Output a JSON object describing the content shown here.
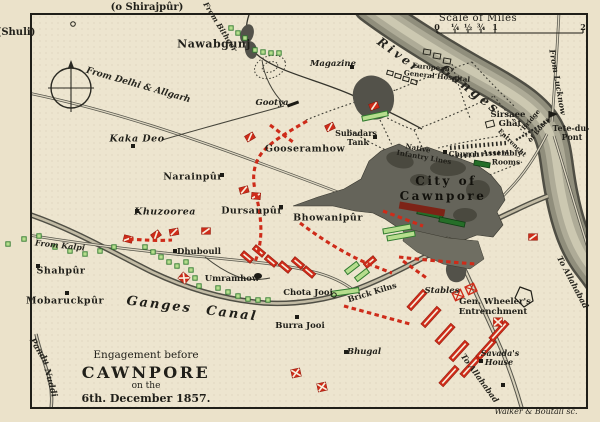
{
  "map": {
    "title_block": {
      "line1": "Engagement before",
      "line2": "CAWNPORE",
      "line3": "on the",
      "line4": "6th. December 1857."
    },
    "scale": {
      "title": "Scale of Miles",
      "ticks": [
        {
          "label": "0",
          "x": 437
        },
        {
          "label": "¼",
          "x": 455
        },
        {
          "label": "½",
          "x": 468
        },
        {
          "label": "¾",
          "x": 481
        },
        {
          "label": "1",
          "x": 495
        },
        {
          "label": "2",
          "x": 583
        }
      ]
    },
    "colors": {
      "paper": "#ebe2ca",
      "map_paper": "#ede5cf",
      "ink": "#201f19",
      "red": "#ce2b19",
      "green_fill": "#b6dd8d",
      "green_dark": "#2f7b2e",
      "river_body": "#908e7c",
      "city_fill": "#65645a"
    },
    "labels": [
      {
        "t": "(o Shirajpûr)",
        "x": 147,
        "y": 8,
        "r": 0,
        "c": "out",
        "s": 10
      },
      {
        "t": "(Shuli)",
        "x": 16,
        "y": 33,
        "r": 0,
        "c": "out",
        "s": 10
      },
      {
        "t": "Walker & Boutall sc.",
        "x": 536,
        "y": 412,
        "r": 0,
        "c": "eng",
        "s": 8
      },
      {
        "t": "Nawabgunj",
        "x": 214,
        "y": 44,
        "r": 0,
        "c": "big",
        "s": 11
      },
      {
        "t": "Magazine",
        "x": 333,
        "y": 64,
        "r": 0,
        "c": "pi",
        "s": 8.5
      },
      {
        "t": "Gootya",
        "x": 272,
        "y": 103,
        "r": 0,
        "c": "pi",
        "s": 8.5
      },
      {
        "t": "European",
        "x": 431,
        "y": 67,
        "r": 6,
        "c": "t",
        "s": 7
      },
      {
        "t": "General Hospital",
        "x": 437,
        "y": 76,
        "r": 6,
        "c": "t",
        "s": 7
      },
      {
        "t": "Sirsaee",
        "x": 508,
        "y": 115,
        "r": 0,
        "c": "p",
        "s": 8.5
      },
      {
        "t": "Ghât",
        "x": 510,
        "y": 124,
        "r": 0,
        "c": "p",
        "s": 8.5
      },
      {
        "t": "Tete-du-",
        "x": 571,
        "y": 128,
        "r": 0,
        "c": "p",
        "s": 8
      },
      {
        "t": "Pont",
        "x": 572,
        "y": 137,
        "r": 0,
        "c": "p",
        "s": 8
      },
      {
        "t": "Bridge",
        "x": 531,
        "y": 120,
        "r": -50,
        "c": "t",
        "s": 6.5
      },
      {
        "t": "of Boats",
        "x": 539,
        "y": 130,
        "r": -50,
        "c": "t",
        "s": 6.5
      },
      {
        "t": "Entrencht",
        "x": 512,
        "y": 143,
        "r": 44,
        "c": "t",
        "s": 6.5
      },
      {
        "t": "Church",
        "x": 464,
        "y": 154,
        "r": 0,
        "c": "p",
        "s": 7.5
      },
      {
        "t": "Assembly",
        "x": 502,
        "y": 153,
        "r": 0,
        "c": "p",
        "s": 7.5
      },
      {
        "t": "Rooms",
        "x": 506,
        "y": 162,
        "r": 0,
        "c": "p",
        "s": 7.5
      },
      {
        "t": "Native",
        "x": 418,
        "y": 148,
        "r": 10,
        "c": "p",
        "s": 7
      },
      {
        "t": "Infantry Lines",
        "x": 424,
        "y": 157,
        "r": 10,
        "c": "p",
        "s": 7
      },
      {
        "t": "Subadars",
        "x": 356,
        "y": 133,
        "r": 0,
        "c": "p",
        "s": 8
      },
      {
        "t": "Tank",
        "x": 358,
        "y": 142,
        "r": 0,
        "c": "p",
        "s": 8
      },
      {
        "t": "Gooseramhow",
        "x": 305,
        "y": 149,
        "r": 0,
        "c": "big",
        "s": 9.5
      },
      {
        "t": "Kaka Deo",
        "x": 137,
        "y": 139,
        "r": 0,
        "c": "bigi",
        "s": 9.5
      },
      {
        "t": "Narainpûr",
        "x": 193,
        "y": 177,
        "r": 0,
        "c": "big",
        "s": 9.5
      },
      {
        "t": "Khuzoorea",
        "x": 165,
        "y": 212,
        "r": 0,
        "c": "bigi",
        "s": 9.5
      },
      {
        "t": "Dursanpûr",
        "x": 252,
        "y": 211,
        "r": 0,
        "c": "big",
        "s": 9.5
      },
      {
        "t": "Bhowanipûr",
        "x": 328,
        "y": 218,
        "r": 0,
        "c": "big",
        "s": 9.5
      },
      {
        "t": "City of",
        "x": 446,
        "y": 181,
        "r": 0,
        "c": "city",
        "s": 12
      },
      {
        "t": "Cawnpore",
        "x": 443,
        "y": 196,
        "r": 0,
        "c": "city",
        "s": 12
      },
      {
        "t": "Shahpûr",
        "x": 61,
        "y": 271,
        "r": 0,
        "c": "big",
        "s": 9.5
      },
      {
        "t": "Mobaruckpûr",
        "x": 65,
        "y": 301,
        "r": 0,
        "c": "big",
        "s": 9.5
      },
      {
        "t": "Dhuboull",
        "x": 199,
        "y": 252,
        "r": 0,
        "c": "p",
        "s": 8.5
      },
      {
        "t": "Umramhow",
        "x": 232,
        "y": 279,
        "r": 0,
        "c": "p",
        "s": 8.5
      },
      {
        "t": "Chota Jooi",
        "x": 308,
        "y": 293,
        "r": 0,
        "c": "p",
        "s": 8.5
      },
      {
        "t": "Burra Jooi",
        "x": 300,
        "y": 326,
        "r": 0,
        "c": "p",
        "s": 8.5
      },
      {
        "t": "Brick Kilns",
        "x": 372,
        "y": 292,
        "r": -17,
        "c": "p",
        "s": 8
      },
      {
        "t": "Stables",
        "x": 442,
        "y": 291,
        "r": 0,
        "c": "pi",
        "s": 8.5
      },
      {
        "t": "Gen. Wheeler's",
        "x": 495,
        "y": 302,
        "r": 0,
        "c": "p",
        "s": 8.5
      },
      {
        "t": "Entrenchment",
        "x": 493,
        "y": 312,
        "r": 0,
        "c": "p",
        "s": 8.5
      },
      {
        "t": "Savada's",
        "x": 500,
        "y": 353,
        "r": 0,
        "c": "pi",
        "s": 8
      },
      {
        "t": "House",
        "x": 499,
        "y": 362,
        "r": 0,
        "c": "pi",
        "s": 8
      },
      {
        "t": "Bhugal",
        "x": 364,
        "y": 352,
        "r": 0,
        "c": "pi",
        "s": 8.5
      },
      {
        "t": "River",
        "x": 399,
        "y": 55,
        "r": 36,
        "c": "rv",
        "s": 12
      },
      {
        "t": "Ganges",
        "x": 470,
        "y": 90,
        "r": 38,
        "c": "rv",
        "s": 13
      },
      {
        "t": "From Bithoor",
        "x": 220,
        "y": 27,
        "r": 58,
        "c": "rd",
        "s": 7.5
      },
      {
        "t": "From Delhi & Allgarh",
        "x": 138,
        "y": 86,
        "r": 16,
        "c": "rd",
        "s": 9
      },
      {
        "t": "From Kalpi",
        "x": 60,
        "y": 245,
        "r": 6,
        "c": "rd",
        "s": 8
      },
      {
        "t": "Ganges Canal",
        "x": 192,
        "y": 309,
        "r": 7,
        "c": "canal",
        "s": 13
      },
      {
        "t": "To Allahabad",
        "x": 480,
        "y": 378,
        "r": 54,
        "c": "rd",
        "s": 8
      },
      {
        "t": "To Allahabad",
        "x": 573,
        "y": 282,
        "r": 62,
        "c": "rd",
        "s": 8
      },
      {
        "t": "From Lucknow",
        "x": 558,
        "y": 82,
        "r": 80,
        "c": "rd",
        "s": 8
      },
      {
        "t": "Pandu",
        "x": 39,
        "y": 352,
        "r": 58,
        "c": "rd",
        "s": 8.5
      },
      {
        "t": "Nuddi",
        "x": 50,
        "y": 383,
        "r": 75,
        "c": "rd",
        "s": 8.5
      }
    ],
    "markers": {
      "green_squares": [
        [
          231,
          28
        ],
        [
          238,
          33
        ],
        [
          245,
          38
        ],
        [
          255,
          50
        ],
        [
          263,
          52
        ],
        [
          271,
          53
        ],
        [
          279,
          53
        ],
        [
          8,
          244
        ],
        [
          24,
          239
        ],
        [
          39,
          236
        ],
        [
          55,
          247
        ],
        [
          70,
          251
        ],
        [
          85,
          254
        ],
        [
          100,
          251
        ],
        [
          114,
          247
        ],
        [
          145,
          247
        ],
        [
          153,
          252
        ],
        [
          161,
          257
        ],
        [
          169,
          262
        ],
        [
          177,
          266
        ],
        [
          186,
          262
        ],
        [
          191,
          270
        ],
        [
          195,
          278
        ],
        [
          199,
          286
        ],
        [
          218,
          288
        ],
        [
          228,
          292
        ],
        [
          238,
          296
        ],
        [
          248,
          299
        ],
        [
          258,
          300
        ],
        [
          268,
          300
        ]
      ],
      "green_bars": [
        [
          345,
          292,
          -8,
          28
        ],
        [
          352,
          268,
          -38,
          15
        ],
        [
          362,
          275,
          -38,
          15
        ],
        [
          375,
          116,
          -12,
          26
        ],
        [
          397,
          229,
          -10,
          28
        ],
        [
          401,
          236,
          -10,
          28
        ]
      ],
      "green_bars_dark": [
        [
          430,
          214,
          12,
          26
        ],
        [
          452,
          222,
          12,
          26
        ],
        [
          482,
          164,
          10,
          16
        ]
      ],
      "red_flags": [
        [
          250,
          137,
          -30
        ],
        [
          244,
          190,
          -15
        ],
        [
          256,
          196,
          5
        ],
        [
          174,
          232,
          -10
        ],
        [
          156,
          235,
          -35
        ],
        [
          128,
          239,
          15
        ],
        [
          206,
          231,
          0
        ],
        [
          330,
          127,
          -25
        ],
        [
          374,
          106,
          -20
        ],
        [
          533,
          237,
          0
        ]
      ],
      "red_x": [
        [
          296,
          373,
          -12,
          1
        ],
        [
          322,
          387,
          -12,
          1
        ],
        [
          498,
          322,
          0,
          1
        ],
        [
          184,
          278,
          40,
          1
        ],
        [
          458,
          295,
          -25,
          0
        ],
        [
          471,
          289,
          -25,
          0
        ]
      ],
      "red_bars": [
        [
          417,
          300,
          -48,
          24
        ],
        [
          431,
          317,
          -48,
          24
        ],
        [
          445,
          334,
          -48,
          24
        ],
        [
          459,
          351,
          -48,
          24
        ],
        [
          449,
          376,
          -48,
          24
        ],
        [
          470,
          367,
          -48,
          24
        ],
        [
          486,
          349,
          -48,
          24
        ],
        [
          499,
          331,
          -48,
          24
        ],
        [
          247,
          257,
          40,
          13
        ],
        [
          259,
          251,
          40,
          13
        ],
        [
          271,
          261,
          40,
          13
        ],
        [
          285,
          267,
          40,
          13
        ],
        [
          298,
          263,
          40,
          13
        ],
        [
          309,
          272,
          40,
          13
        ],
        [
          370,
          262,
          -40,
          13
        ]
      ],
      "maroon_bar": [
        422,
        209,
        10,
        46
      ],
      "red_dash_paths": [
        "M307,121 C288,132 270,142 261,154 C254,164 252,176 255,190",
        "M256,194 C260,212 263,230 259,248 C258,254 256,260 254,264",
        "M383,211 C396,216 410,221 423,226",
        "M399,257 C424,260 450,262 476,264",
        "M344,306 C366,312 388,318 410,324",
        "M129,239 C144,240 158,241 172,240",
        "M270,125 C278,131 286,137 293,142",
        "M300,223 C320,238 342,252 364,262 C374,266 384,270 392,273",
        "M403,261 L428,279"
      ],
      "black_squares": [
        [
          352,
          67
        ],
        [
          445,
          152
        ],
        [
          375,
          137
        ],
        [
          222,
          175
        ],
        [
          137,
          211
        ],
        [
          38,
          266
        ],
        [
          67,
          293
        ],
        [
          175,
          251
        ],
        [
          281,
          207
        ],
        [
          297,
          317
        ],
        [
          346,
          352
        ],
        [
          481,
          361
        ],
        [
          503,
          385
        ],
        [
          133,
          146
        ]
      ],
      "black_blob": [
        258,
        276
      ],
      "black_bar": [
        293,
        104,
        -20,
        12
      ],
      "hollow_rects": [
        [
          427,
          52,
          7,
          5,
          10
        ],
        [
          437,
          56,
          7,
          5,
          10
        ],
        [
          447,
          61,
          7,
          5,
          10
        ],
        [
          390,
          73,
          6,
          4,
          15
        ],
        [
          398,
          76,
          6,
          4,
          15
        ],
        [
          406,
          79,
          6,
          4,
          15
        ],
        [
          414,
          82,
          6,
          4,
          15
        ],
        [
          490,
          124,
          8,
          6,
          -15
        ]
      ],
      "hollow_circles": [
        [
          334,
          295
        ],
        [
          73,
          24
        ]
      ],
      "pentagon": "520,287 531,291 533,301 524,307 515,298"
    }
  }
}
